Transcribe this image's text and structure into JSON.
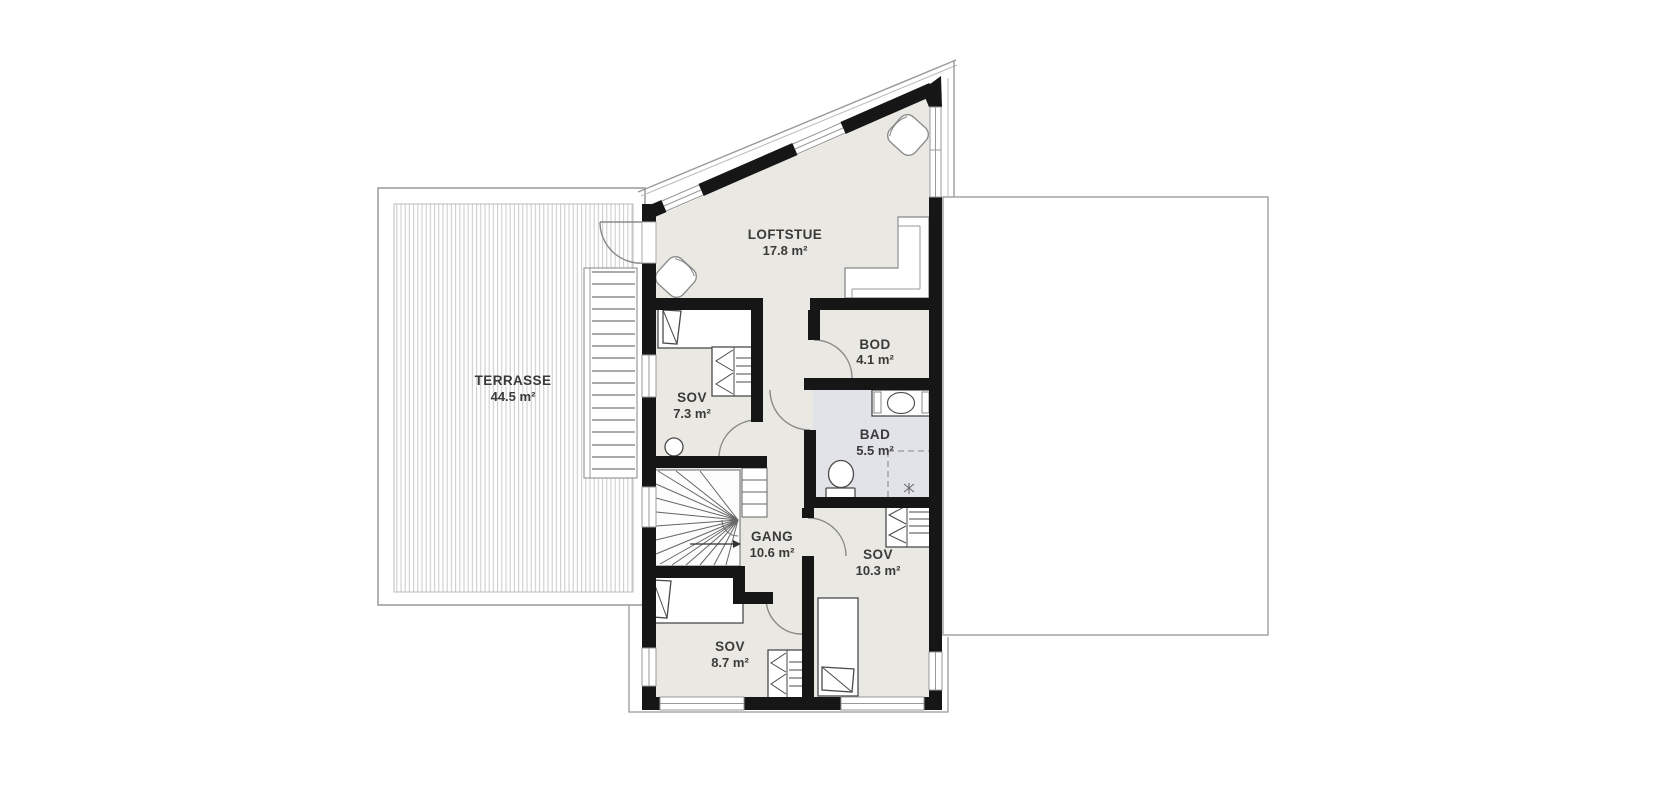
{
  "plan_title": "Loft floor plan",
  "colors": {
    "background": "#ffffff",
    "wall": "#161616",
    "floor": "#e9e8e2",
    "bath_floor": "#e2e3e8",
    "outline": "#999999",
    "text": "#3a3a3a"
  },
  "rooms": {
    "terrasse": {
      "name": "TERRASSE",
      "area": "44.5 m²"
    },
    "loftstue": {
      "name": "LOFTSTUE",
      "area": "17.8 m²"
    },
    "sov_top": {
      "name": "SOV",
      "area": "7.3 m²"
    },
    "bod": {
      "name": "BOD",
      "area": "4.1 m²"
    },
    "bad": {
      "name": "BAD",
      "area": "5.5 m²"
    },
    "gang": {
      "name": "GANG",
      "area": "10.6 m²"
    },
    "sov_right": {
      "name": "SOV",
      "area": "10.3 m²"
    },
    "sov_bottom": {
      "name": "SOV",
      "area": "8.7 m²"
    }
  }
}
